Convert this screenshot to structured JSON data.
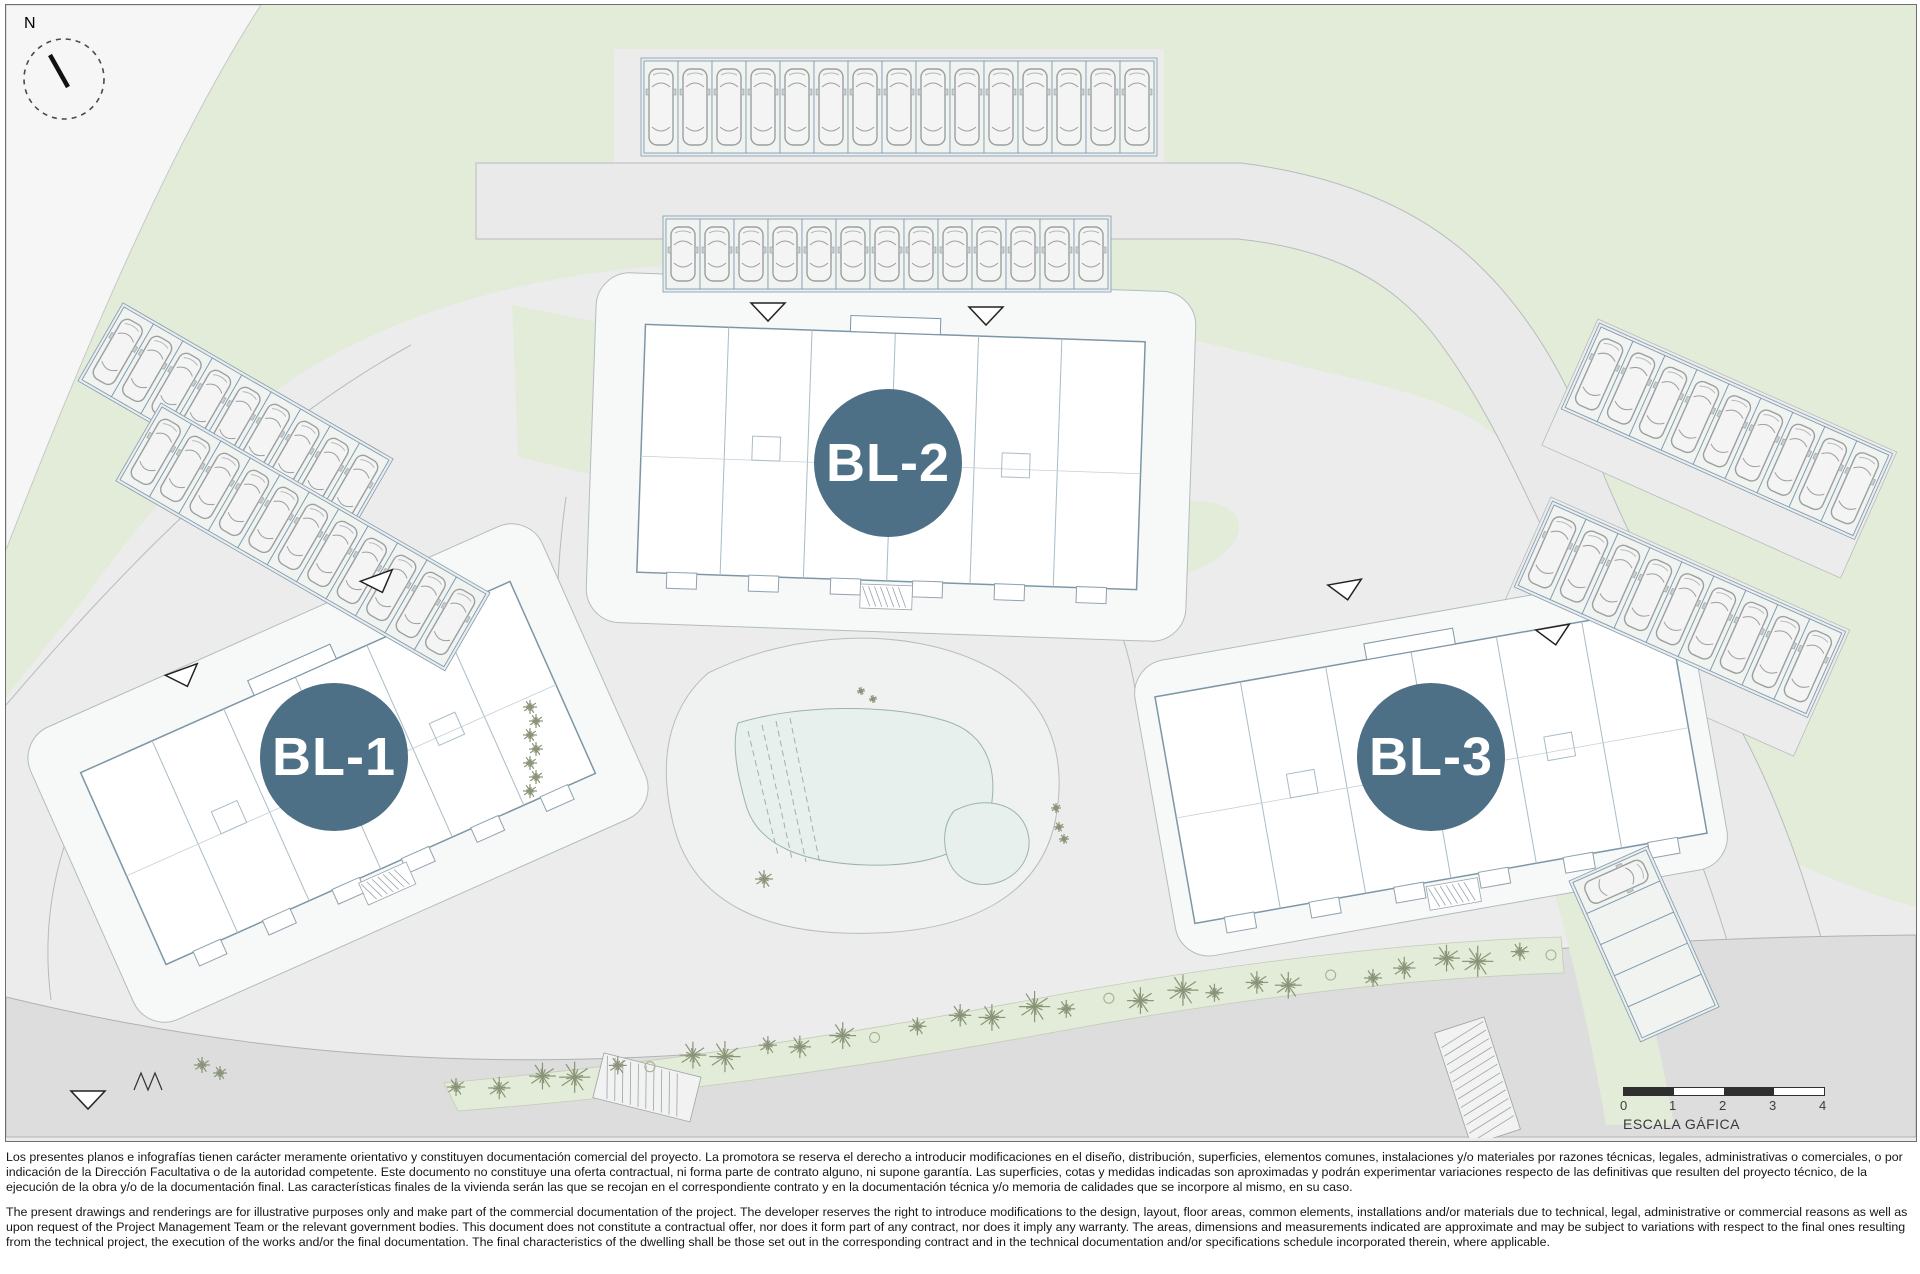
{
  "plan": {
    "north_label": "N",
    "blocks": [
      {
        "label": "BL-1"
      },
      {
        "label": "BL-2"
      },
      {
        "label": "BL-3"
      }
    ],
    "scale_bar": {
      "ticks": [
        "0",
        "1",
        "2",
        "3",
        "4"
      ],
      "label": "ESCALA GÁFICA"
    },
    "colors": {
      "badge": "#4d7086",
      "greenery": "#e3ecd8",
      "site_gray": "#ececec",
      "road_gray": "#e9eae9",
      "main_road_gray": "#dcdddc",
      "pool_water": "#e7f0ec",
      "building_outline": "#7d96a6",
      "parking_line": "#7f9cb0",
      "tree_green": "#8a9478"
    }
  },
  "disclaimer": {
    "spanish": "Los presentes planos e infografías tienen carácter meramente orientativo y constituyen documentación comercial del proyecto. La promotora se reserva el derecho a introducir modificaciones en el diseño, distribución, superficies, elementos comunes, instalaciones y/o materiales por razones técnicas, legales, administrativas o comerciales, o por indicación de la Dirección Facultativa o de la autoridad competente. Este documento no constituye una oferta contractual, ni forma parte de contrato alguno, ni supone garantía. Las superficies, cotas y medidas indicadas son aproximadas y podrán experimentar variaciones respecto de las definitivas que resulten del proyecto técnico, de la ejecución de la obra y/o de la documentación final. Las características finales de la vivienda serán las que se recojan en el correspondiente contrato y en la documentación técnica y/o memoria de calidades que se incorpore al mismo, en su caso.",
    "english": "The present drawings and renderings are for illustrative purposes only and make part of the commercial documentation of the project. The developer reserves the right to introduce modifications to the design, layout, floor areas, common elements, installations and/or materials due to technical, legal, administrative or commercial reasons as well as upon request of the Project Management Team or the relevant government bodies. This document does not constitute a contractual offer, nor does it form part of any contract, nor does it imply any warranty. The areas, dimensions and measurements indicated are approximate and may be subject to variations with respect to the final ones resulting from the technical project, the execution of the works and/or the final documentation. The final characteristics of the dwelling shall be those set out in the corresponding contract and in the technical documentation and/or specifications schedule incorporated therein, where applicable."
  }
}
